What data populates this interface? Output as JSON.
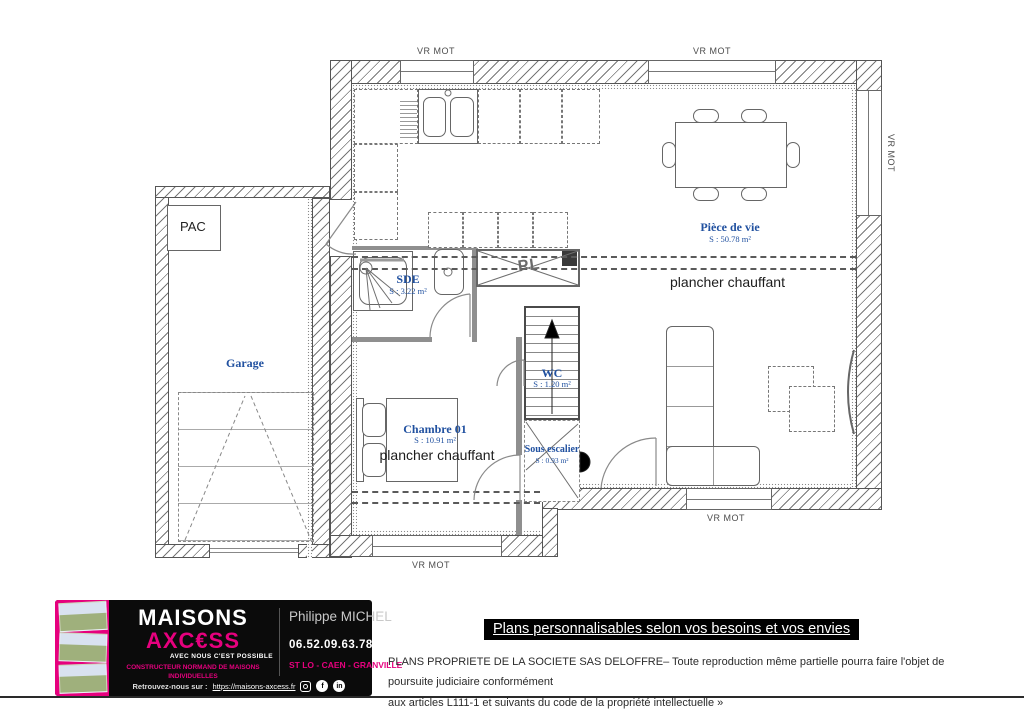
{
  "plan": {
    "window_label": "VR MOT",
    "rooms": {
      "piece_de_vie": {
        "name": "Pièce de vie",
        "area": "S : 50.78 m²"
      },
      "sde": {
        "name": "SDE",
        "area": "S : 3.22 m²"
      },
      "wc": {
        "name": "WC",
        "area": "S : 1.20 m²"
      },
      "sous_escalier": {
        "name": "Sous escalier",
        "area": "S : 0.93 m²"
      },
      "chambre01": {
        "name": "Chambre 01",
        "area": "S : 10.91 m²"
      },
      "garage": {
        "name": "Garage"
      }
    },
    "labels": {
      "plancher_chauffant": "plancher chauffant",
      "pac": "PAC",
      "pl": "PL"
    },
    "colors": {
      "room_label_blue": "#2151a0",
      "wall_line": "#555555"
    }
  },
  "banner": {
    "text": "Plans personnalisables selon vos besoins et vos envies"
  },
  "legal": {
    "line1": "PLANS PROPRIETE DE LA SOCIETE SAS DELOFFRE– Toute reproduction même partielle pourra faire l'objet de poursuite judiciaire conformément",
    "line2": "aux articles L111-1 et suivants du code de la propriété intellectuelle »"
  },
  "footer": {
    "brand": {
      "line1": "MAISONS",
      "line2": "AXC€SS",
      "tagline": "AVEC NOUS C'EST POSSIBLE",
      "subtitle": "CONSTRUCTEUR NORMAND DE MAISONS INDIVIDUELLES"
    },
    "contact": {
      "name": "Philippe MICHEL",
      "phone": "06.52.09.63.78",
      "cities": "ST LO - CAEN - GRANVILLE"
    },
    "social": {
      "prefix": "Retrouvez-nous sur :",
      "url": "https://maisons-axcess.fr"
    },
    "colors": {
      "pink": "#E6007E",
      "black": "#0b0b0b"
    }
  }
}
